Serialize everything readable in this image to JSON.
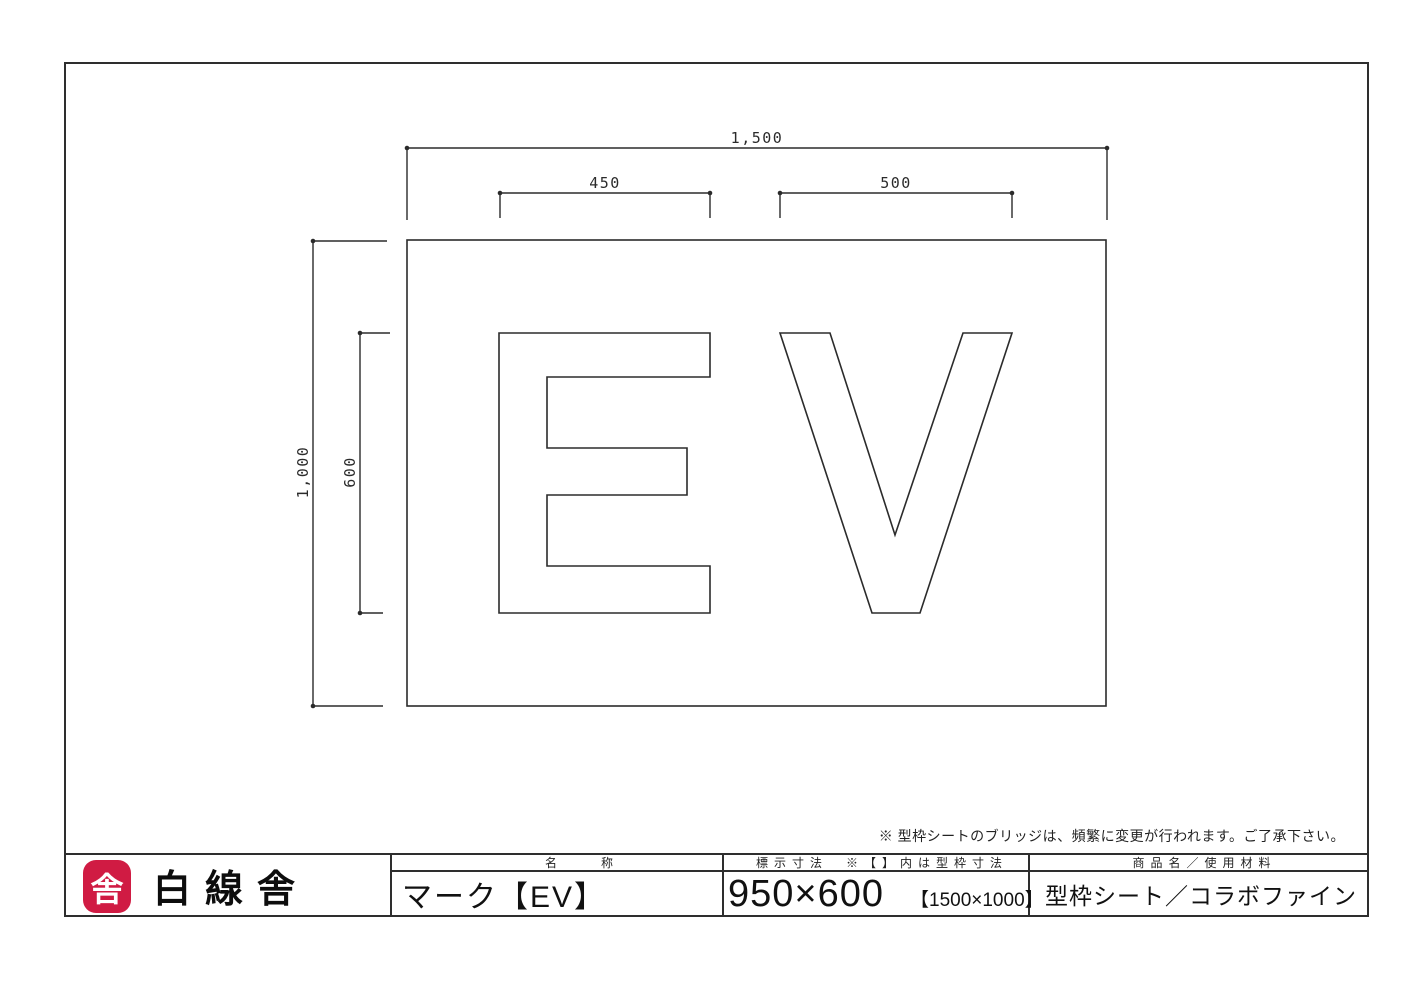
{
  "drawing": {
    "dims": {
      "overall_width": "1,500",
      "letter_e_width": "450",
      "letter_v_width": "500",
      "overall_height": "1,000",
      "letter_height": "600"
    },
    "letters": {
      "e_points": "499,333 710,333 710,377 547,377 547,448 687,448 687,495 547,495 547,566 710,566 710,613 499,613",
      "v_points": "780,333 830,333 895,535 963,333 1012,333 920,613 872,613"
    },
    "note": "※ 型枠シートのブリッジは、頻繁に変更が行われます。ご了承下さい。"
  },
  "title_block": {
    "logo_glyph": "舎",
    "company": "白線舎",
    "name_header": "名称",
    "name_value": "マーク【EV】",
    "size_header": "標示寸法　※【】内は型枠寸法",
    "size_value": "950×600",
    "size_bracket": "【1500×1000】",
    "material_header": "商品名／使用材料",
    "material_value": "型枠シート／コラボファイン"
  },
  "colors": {
    "line": "#2b2b2b",
    "logo_red": "#d01b43"
  }
}
